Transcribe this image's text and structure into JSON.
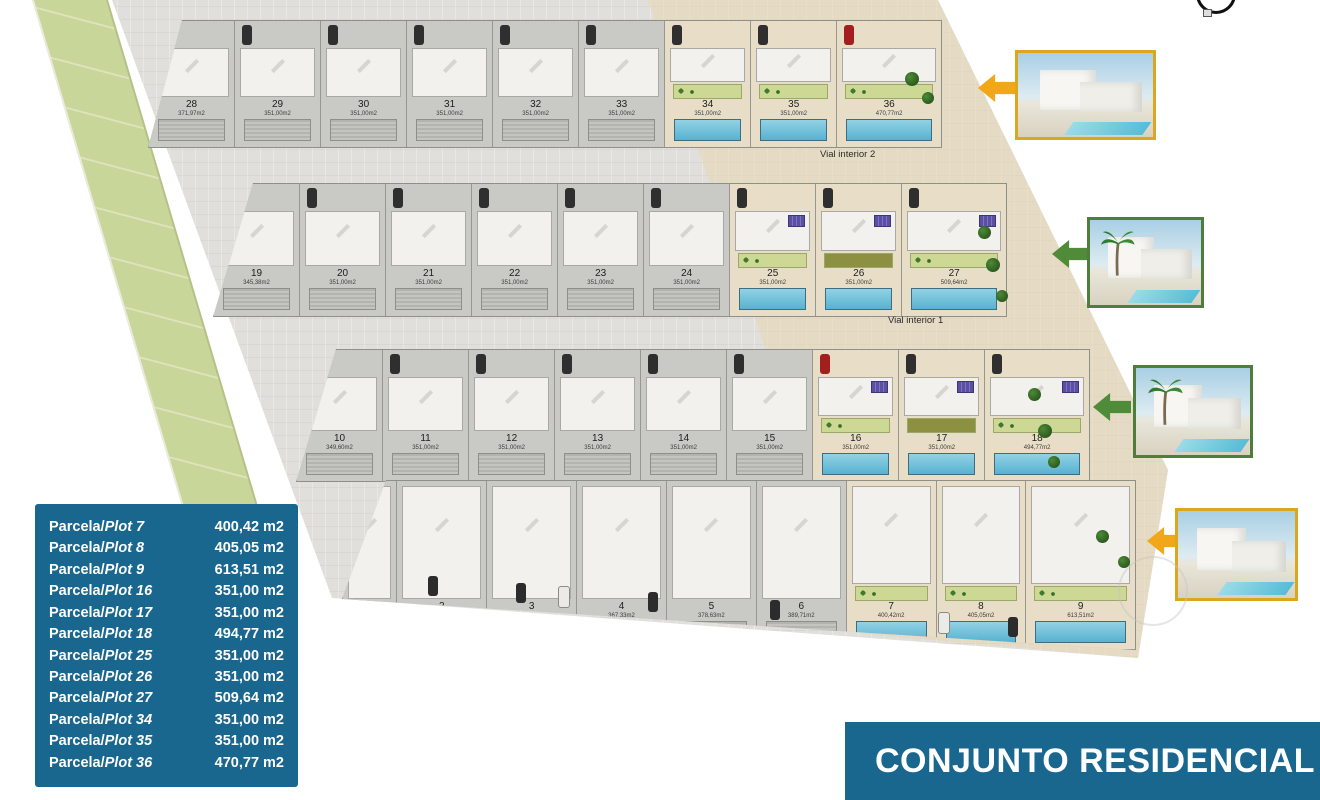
{
  "site_plan": {
    "road_labels": [
      {
        "text": "Vial interior 2"
      },
      {
        "text": "Vial interior 1"
      }
    ],
    "rows": [
      {
        "plots": [
          {
            "num": "28",
            "area": "371,97m2"
          },
          {
            "num": "29",
            "area": "351,00m2"
          },
          {
            "num": "30",
            "area": "351,00m2"
          },
          {
            "num": "31",
            "area": "351,00m2"
          },
          {
            "num": "32",
            "area": "351,00m2"
          },
          {
            "num": "33",
            "area": "351,00m2"
          },
          {
            "num": "34",
            "area": "351,00m2"
          },
          {
            "num": "35",
            "area": "351,00m2"
          },
          {
            "num": "36",
            "area": "470,77m2"
          }
        ]
      },
      {
        "plots": [
          {
            "num": "19",
            "area": "345,38m2"
          },
          {
            "num": "20",
            "area": "351,00m2"
          },
          {
            "num": "21",
            "area": "351,00m2"
          },
          {
            "num": "22",
            "area": "351,00m2"
          },
          {
            "num": "23",
            "area": "351,00m2"
          },
          {
            "num": "24",
            "area": "351,00m2"
          },
          {
            "num": "25",
            "area": "351,00m2"
          },
          {
            "num": "26",
            "area": "351,00m2"
          },
          {
            "num": "27",
            "area": "509,64m2"
          }
        ]
      },
      {
        "plots": [
          {
            "num": "10",
            "area": "349,60m2"
          },
          {
            "num": "11",
            "area": "351,00m2"
          },
          {
            "num": "12",
            "area": "351,00m2"
          },
          {
            "num": "13",
            "area": "351,00m2"
          },
          {
            "num": "14",
            "area": "351,00m2"
          },
          {
            "num": "15",
            "area": "351,00m2"
          },
          {
            "num": "16",
            "area": "351,00m2"
          },
          {
            "num": "17",
            "area": "351,00m2"
          },
          {
            "num": "18",
            "area": "494,77m2"
          }
        ]
      },
      {
        "plots": [
          {
            "num": "1",
            "area": "290,71m2"
          },
          {
            "num": "2",
            "area": "300,30m2"
          },
          {
            "num": "3",
            "area": "356,48m2"
          },
          {
            "num": "4",
            "area": "367,33m2"
          },
          {
            "num": "5",
            "area": "378,63m2"
          },
          {
            "num": "6",
            "area": "389,71m2"
          },
          {
            "num": "7",
            "area": "400,42m2"
          },
          {
            "num": "8",
            "area": "405,05m2"
          },
          {
            "num": "9",
            "area": "613,51m2"
          }
        ]
      }
    ]
  },
  "legend": {
    "rows": [
      {
        "prefix": "Parcela/",
        "plot": "Plot 7",
        "area": "400,42 m2"
      },
      {
        "prefix": "Parcela/",
        "plot": "Plot 8",
        "area": "405,05 m2"
      },
      {
        "prefix": "Parcela/",
        "plot": "Plot 9",
        "area": "613,51 m2"
      },
      {
        "prefix": "Parcela/",
        "plot": "Plot 16",
        "area": "351,00 m2"
      },
      {
        "prefix": "Parcela/",
        "plot": "Plot 17",
        "area": "351,00 m2"
      },
      {
        "prefix": "Parcela/",
        "plot": "Plot 18",
        "area": "494,77 m2"
      },
      {
        "prefix": "Parcela/",
        "plot": "Plot 25",
        "area": "351,00 m2"
      },
      {
        "prefix": "Parcela/",
        "plot": "Plot 26",
        "area": "351,00 m2"
      },
      {
        "prefix": "Parcela/",
        "plot": "Plot 27",
        "area": "509,64 m2"
      },
      {
        "prefix": "Parcela/",
        "plot": "Plot 34",
        "area": "351,00 m2"
      },
      {
        "prefix": "Parcela/",
        "plot": "Plot 35",
        "area": "351,00 m2"
      },
      {
        "prefix": "Parcela/",
        "plot": "Plot 36",
        "area": "470,77 m2"
      }
    ]
  },
  "banner": {
    "title": "CONJUNTO RESIDENCIAL"
  },
  "colors": {
    "accent_blue": "#19678f",
    "arrow_yellow": "#f2a71b",
    "arrow_green": "#4f8b38",
    "frame_yellow": "#d9a81f",
    "frame_green": "#4e7d3c",
    "pool_blue": "#58b2d1",
    "garden_green": "#ccd894",
    "strip_green": "#c9d699"
  }
}
